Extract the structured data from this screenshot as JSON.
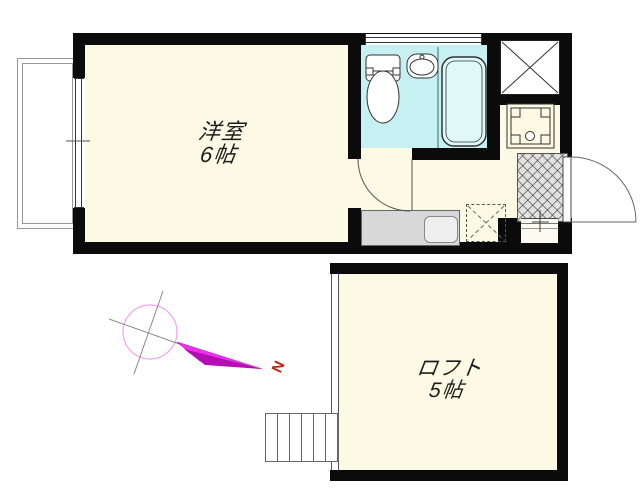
{
  "rooms": {
    "main": {
      "name": "洋室",
      "size": "6帖"
    },
    "loft": {
      "name": "ロフト",
      "size": "5帖"
    }
  },
  "compass": {
    "north_label": "N"
  },
  "colors": {
    "floor_cream": "#FCF9E4",
    "bath_cyan": "#C6F0F2",
    "tub_cyan": "#DFF8F8",
    "wall_black": "#0B0B0B",
    "counter_gray": "#D8D8D8",
    "hatch_gray": "#E2E2E2",
    "compass_magenta": "#EE30EE",
    "north_red": "#C42015"
  }
}
